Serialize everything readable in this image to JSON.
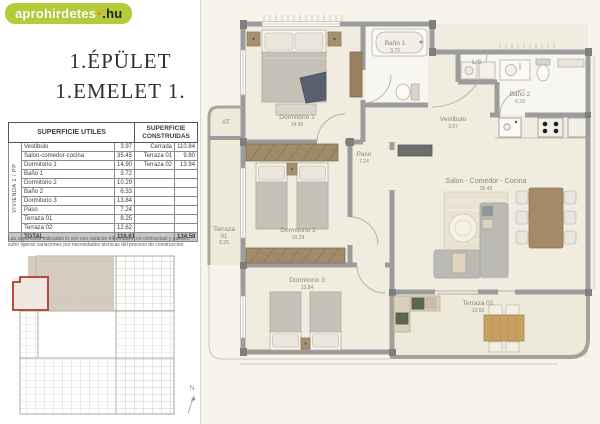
{
  "logo": {
    "main": "aprohirdetes",
    "dot": "▪",
    "suffix": ".hu"
  },
  "title": {
    "line1": "1.ÉPÜLET",
    "line2": "1.EMELET 1."
  },
  "area_table": {
    "header_utiles": "SUPERFICIE UTILES",
    "header_construidas": "SUPERFICIE CONSTRUIDAS",
    "vivienda_label": "VIVIENDA 1 / PP",
    "rows": [
      {
        "name": "Vestibulo",
        "value": "3.97"
      },
      {
        "name": "Salon-comedor-cocina",
        "value": "35.45"
      },
      {
        "name": "Dormitorio 1",
        "value": "14.90"
      },
      {
        "name": "Baño 1",
        "value": "3.72"
      },
      {
        "name": "Dormitorio 2",
        "value": "10.29"
      },
      {
        "name": "Baño 2",
        "value": "6.33"
      },
      {
        "name": "Dormitorio 3",
        "value": "13.84"
      },
      {
        "name": "Paso",
        "value": "7.24"
      },
      {
        "name": "Terraza 01",
        "value": "8.25"
      },
      {
        "name": "Terraza 02",
        "value": "12.62"
      }
    ],
    "constructed": [
      {
        "name": "Cerrada",
        "value": "110.84"
      },
      {
        "name": "Terraza 01",
        "value": "9.80"
      },
      {
        "name": "Terraza 02",
        "value": "13.94"
      }
    ],
    "total_label": "TOTAL",
    "total_utiles": "116.61",
    "total_construidas": "134.58"
  },
  "disclaimer": "Las superficies indicadas lo son con carácter informativo, no contractual y pueden sufrir ligeras variaciones por necesidades técnicas del proceso de construcción.",
  "floorplan": {
    "rooms": [
      {
        "name": "Dormitorio 1",
        "area": "14.90"
      },
      {
        "name": "Baño 1",
        "area": "3.72"
      },
      {
        "name": "Vestibulo",
        "area": "3.97"
      },
      {
        "name": "L/S",
        "area": ""
      },
      {
        "name": "Baño 2",
        "area": "6.33"
      },
      {
        "name": "Paso",
        "area": "7.24"
      },
      {
        "name": "Salon - Comedor - Cocina",
        "area": "35.45"
      },
      {
        "name": "Dormitorio 2",
        "area": "10.29"
      },
      {
        "name": "Dormitorio 3",
        "area": "13.84"
      },
      {
        "name": "Terraza",
        "line2": "01",
        "area": "8.25"
      },
      {
        "name": "Terraza 02",
        "area": "12.62"
      },
      {
        "name": "AT",
        "area": ""
      }
    ],
    "north": "N"
  },
  "colors": {
    "logo_green": "#b6cb3a",
    "logo_orange": "#f08418",
    "highlight_red": "#b03a2c",
    "wall_gray": "#9c9c9c"
  }
}
